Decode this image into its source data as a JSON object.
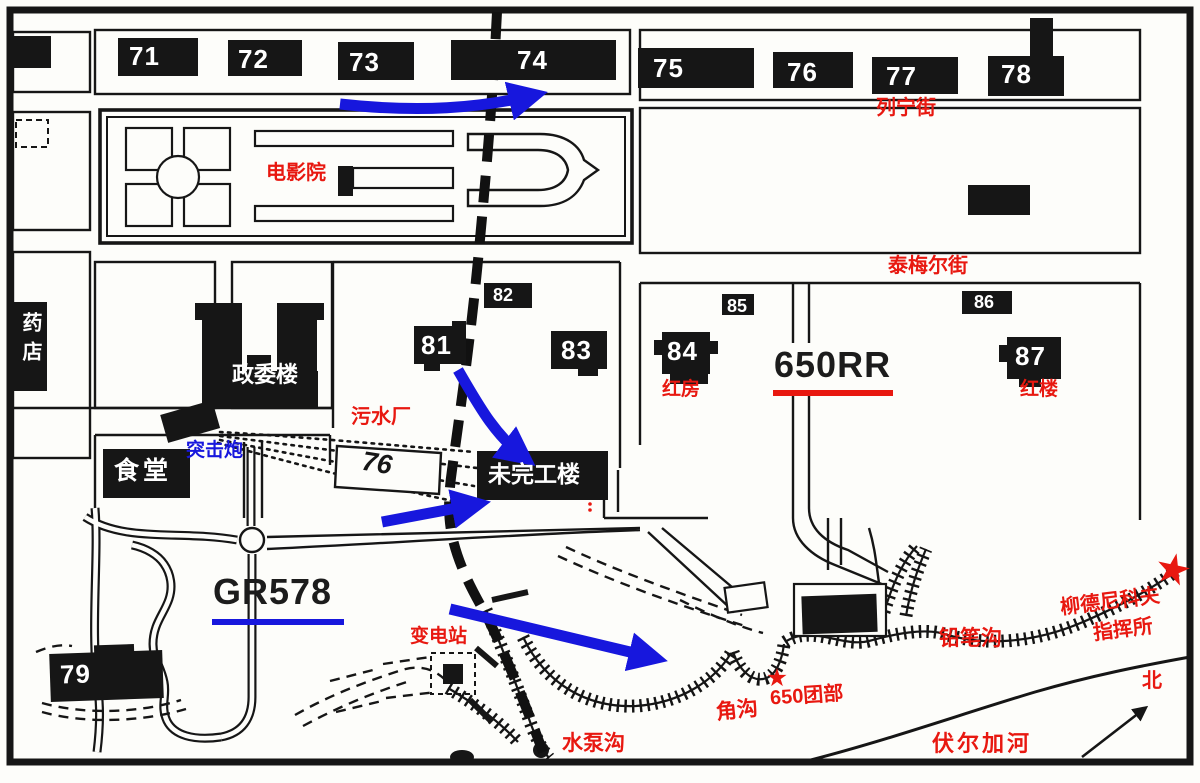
{
  "colors": {
    "red": "#e81810",
    "blue": "#1717dd",
    "ink": "#161616",
    "paper": "#fdfdfa"
  },
  "streets": {
    "lenin_street": "列宁街",
    "taymyr_street": "泰梅尔街"
  },
  "places": {
    "cinema": "电影院",
    "pharmacy": "药店",
    "commissar_building": "政委楼",
    "canteen": "食堂",
    "assault_gun": "突击炮",
    "sewage_plant": "污水厂",
    "unfinished_building": "未完工楼",
    "red_house": "红房",
    "red_building": "红楼",
    "substation": "变电站"
  },
  "units": {
    "rr_650": "650RR",
    "gr_578": "GR578",
    "regiment_650_hq": "650团部",
    "lyudnikov_line1": "柳德尼科夫",
    "lyudnikov_line2": "指挥所"
  },
  "terrain": {
    "pump_gully": "水泵沟",
    "corner_gully": "角沟",
    "pencil_gully": "铅笔沟",
    "volga_river": "伏尔加河",
    "north_indicator": "北"
  },
  "buildings": {
    "b71": "71",
    "b72": "72",
    "b73": "73",
    "b74": "74",
    "b75": "75",
    "b76_top": "76",
    "b77": "77",
    "b78": "78",
    "b79": "79",
    "b76_mid": "76",
    "b81": "81",
    "b82": "82",
    "b83": "83",
    "b84": "84",
    "b85": "85",
    "b86": "86",
    "b87": "87"
  }
}
